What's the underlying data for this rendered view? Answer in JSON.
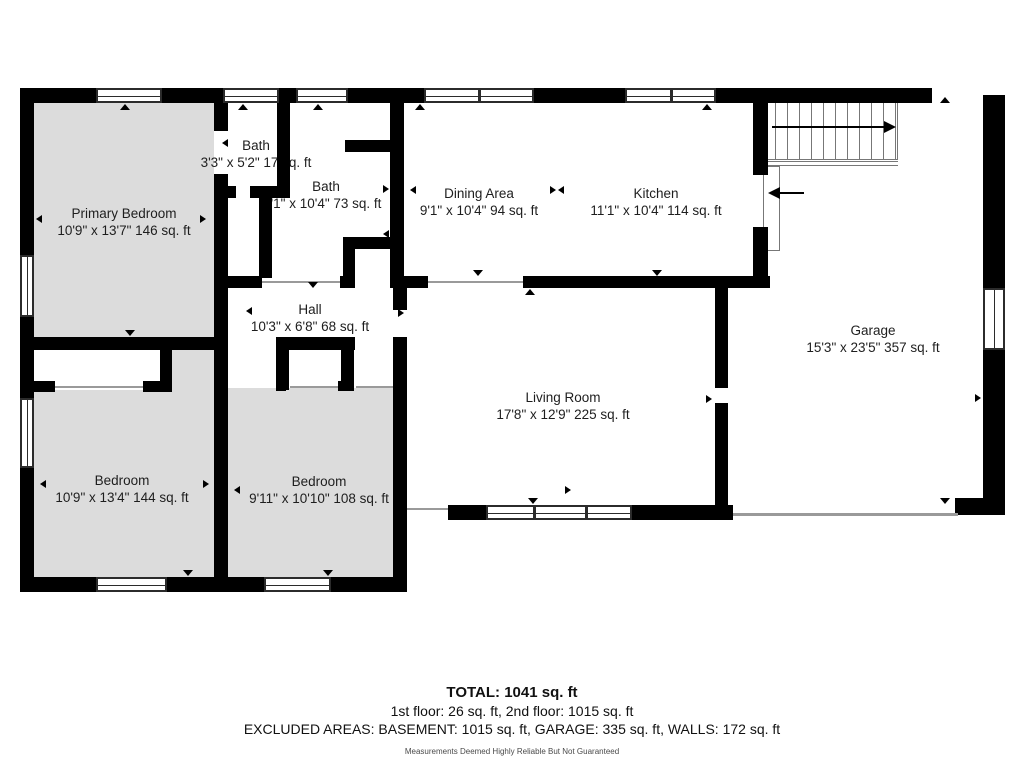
{
  "plan": {
    "rooms": [
      {
        "name": "Primary Bedroom",
        "dims": "10'9\" x 13'7\" 146 sq. ft"
      },
      {
        "name": "Bath",
        "dims": "3'3\" x 5'2\" 17 sq. ft"
      },
      {
        "name": "Bath",
        "dims": "'1\" x 10'4\" 73 sq. ft"
      },
      {
        "name": "Dining Area",
        "dims": "9'1\" x 10'4\" 94 sq. ft"
      },
      {
        "name": "Kitchen",
        "dims": "11'1\" x 10'4\" 114 sq. ft"
      },
      {
        "name": "Hall",
        "dims": "10'3\" x 6'8\" 68 sq. ft"
      },
      {
        "name": "Garage",
        "dims": "15'3\" x 23'5\" 357 sq. ft"
      },
      {
        "name": "Living Room",
        "dims": "17'8\" x 12'9\" 225 sq. ft"
      },
      {
        "name": "Bedroom",
        "dims": "10'9\" x 13'4\" 144 sq. ft"
      },
      {
        "name": "Bedroom",
        "dims": "9'11\" x 10'10\" 108 sq. ft"
      }
    ],
    "colors": {
      "wall": "#000000",
      "bedroom_fill": "#dcdcdc",
      "background": "#ffffff"
    }
  },
  "footer": {
    "total": "TOTAL: 1041 sq. ft",
    "floors": "1st floor: 26 sq. ft, 2nd floor: 1015 sq. ft",
    "excluded": "EXCLUDED AREAS: BASEMENT: 1015 sq. ft, GARAGE: 335 sq. ft, WALLS: 172 sq. ft",
    "disclaimer": "Measurements Deemed Highly Reliable But Not Guaranteed"
  }
}
